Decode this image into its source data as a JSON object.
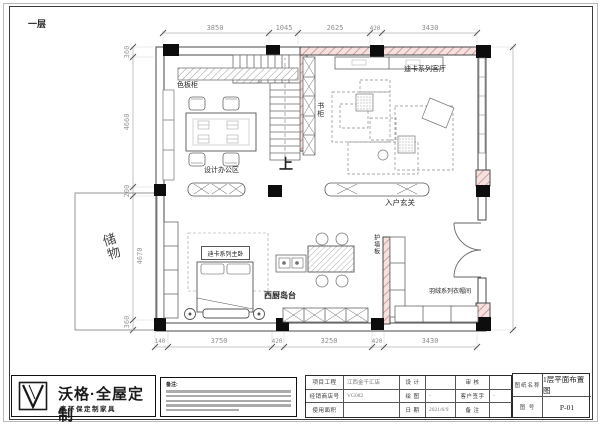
{
  "sheet": {
    "floor_label": "一层"
  },
  "dimensions": {
    "top": [
      "3850",
      "1045",
      "2625",
      "420",
      "3430"
    ],
    "bottom": [
      "140",
      "3750",
      "420",
      "3250",
      "420",
      "3430"
    ],
    "left": [
      "360",
      "4660",
      "200",
      "4670",
      "360"
    ]
  },
  "labels": {
    "sample_board_cabinet": "色板柜",
    "design_office_area": "设计办公区",
    "bookcase": "书柜",
    "stairs_up": "上",
    "living_room": "迪卡系列客厅",
    "entry_foyer": "入户玄关",
    "storage": "储物",
    "master_bedroom": "迪卡系列主卧",
    "west_kitchen_island": "西厨岛台",
    "wall_panel": "护墙板",
    "cloakroom": "羽绒系列衣帽间"
  },
  "title_block": {
    "brand": "沃格·全屋定制",
    "tagline": "真环保定制家具",
    "notes_label": "备注:",
    "project_label": "项目工程",
    "project_value": "江西金千汇店",
    "dealer_label": "经销商店号",
    "dealer_value": "VG082",
    "area_label": "使用面积",
    "area_value": "",
    "design_label": "设 计",
    "design_value": "",
    "draft_label": "绘 图",
    "draft_value": "-",
    "date_label": "日 期",
    "date_value": "2021/6/9",
    "review_label": "审 核",
    "review_value": "",
    "signature_label": "客户签字",
    "signature_value": "-",
    "remark_label": "备 注",
    "remark_value": "",
    "drawing_name_label": "图纸名称",
    "drawing_name_value": "1层平面布置图",
    "drawing_no_label": "图 号",
    "drawing_no_value": "P-01"
  }
}
